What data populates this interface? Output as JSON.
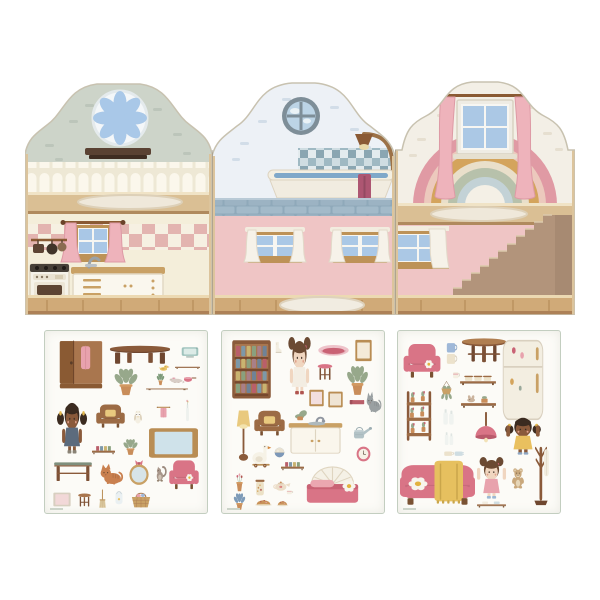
{
  "scene": {
    "kind": "dollhouse-sticker-playset-product-image",
    "background": "#ffffff"
  },
  "palette": {
    "gable_sage": "#cdd4c9",
    "gable_blue_white": "#edf1f6",
    "gable_cream": "#f3efe6",
    "wall_cream": "#f4eeda",
    "wall_pink": "#efc5c5",
    "wood_floor": "#d0aa78",
    "wood_trim": "#bd9257",
    "furniture_pink": "#d97486",
    "furniture_wood": "#9c6b45",
    "curtain_pink": "#eeb3bb",
    "blanket_yellow": "#e6c05f",
    "tile_blue": "#9fb9c3",
    "pane_blue": "#aac8e6"
  },
  "house": {
    "panels": [
      {
        "id": "kitchen-panel",
        "upper_room": "attic-lounge",
        "upper_features": [
          "rosette-flower-window",
          "wall-shelf",
          "scalloped-wainscot",
          "oval-rug"
        ],
        "lower_room": "kitchen",
        "lower_features": [
          "pink-curtain-window",
          "checkered-backsplash",
          "stove-oven",
          "counter-cabinet",
          "sink-faucet",
          "hanging-pan-rail"
        ],
        "wall_colors": {
          "upper": "#cdd4c9",
          "lower": "#f4eeda"
        }
      },
      {
        "id": "bathroom-panel",
        "upper_room": "bathroom",
        "upper_features": [
          "porthole-window",
          "tile-splashback",
          "bathtub",
          "shower-lamp-fixture",
          "hanging-towel",
          "blue-brick-ledge"
        ],
        "lower_room": "hallway",
        "lower_features": [
          "white-curtain-window-left",
          "white-curtain-window-right",
          "white-rug"
        ],
        "wall_colors": {
          "upper": "#edf1f6",
          "lower": "#efc5c5"
        }
      },
      {
        "id": "bedroom-panel",
        "upper_room": "attic-bedroom",
        "upper_features": [
          "rainbow-mural",
          "pink-curtain-window",
          "oval-rug"
        ],
        "lower_room": "stair-hall",
        "lower_features": [
          "white-curtain-window",
          "staircase"
        ],
        "wall_colors": {
          "upper": "#f3efe6",
          "lower": "#efc5c5"
        },
        "rainbow_colors": [
          "#e09aa4",
          "#ecc9bd",
          "#d4a45c",
          "#e9dfca",
          "#b7c1ab",
          "#c3d2d6"
        ]
      }
    ]
  },
  "sticker_sheets": [
    {
      "id": "sheet-living",
      "items": [
        {
          "name": "wardrobe",
          "type": "wardrobe",
          "x": 13,
          "y": 8,
          "w": 46,
          "h": 52
        },
        {
          "name": "coffee-table",
          "type": "table",
          "x": 63,
          "y": 13,
          "w": 64,
          "h": 22,
          "top": "#8a5a3a"
        },
        {
          "name": "tv",
          "type": "tv",
          "x": 136,
          "y": 14,
          "w": 18,
          "h": 14
        },
        {
          "name": "wall-shelf",
          "type": "plank",
          "x": 130,
          "y": 30,
          "w": 25,
          "h": 9,
          "items": "none"
        },
        {
          "name": "potted-plant",
          "type": "plant",
          "x": 64,
          "y": 34,
          "w": 34,
          "h": 32
        },
        {
          "name": "duck-toy",
          "type": "animal",
          "kind": "duck",
          "x": 113,
          "y": 32,
          "w": 12,
          "h": 9
        },
        {
          "name": "cactus-pot",
          "type": "plant",
          "x": 110,
          "y": 41,
          "w": 11,
          "h": 14,
          "leaf": "#7e9b7a"
        },
        {
          "name": "mouse-toy",
          "type": "animal",
          "kind": "mouse",
          "x": 123,
          "y": 44,
          "w": 17,
          "h": 9
        },
        {
          "name": "saucepan",
          "type": "pan",
          "x": 137,
          "y": 41,
          "w": 15,
          "h": 12
        },
        {
          "name": "wooden-plank",
          "type": "plank",
          "x": 101,
          "y": 53,
          "w": 42,
          "h": 7,
          "items": "none"
        },
        {
          "name": "doll-girl-pigtails",
          "type": "doll",
          "x": 11,
          "y": 68,
          "w": 32,
          "h": 55,
          "skin": "#8a5a3b",
          "hair": "#3b2b20",
          "dress": "#5c6b7d",
          "style": "pigtails",
          "boots": "#8a8376"
        },
        {
          "name": "armchair-brown",
          "type": "chair",
          "x": 50,
          "y": 70,
          "w": 31,
          "h": 29,
          "body": "#9c6b45",
          "pillow": "#e9c97e"
        },
        {
          "name": "owl",
          "type": "animal",
          "kind": "owl",
          "x": 87,
          "y": 76,
          "w": 12,
          "h": 18
        },
        {
          "name": "towel-rail",
          "type": "towel",
          "x": 111,
          "y": 73,
          "w": 15,
          "h": 17,
          "color": "#e8a2ad"
        },
        {
          "name": "flower-vase",
          "type": "bottle",
          "x": 138,
          "y": 68,
          "w": 9,
          "h": 24,
          "flower": true
        },
        {
          "name": "book-shelf-small",
          "type": "plank",
          "x": 47,
          "y": 110,
          "w": 23,
          "h": 15,
          "items": "books"
        },
        {
          "name": "potted-plant-small",
          "type": "plant",
          "x": 75,
          "y": 106,
          "w": 21,
          "h": 19
        },
        {
          "name": "framed-board",
          "type": "board",
          "x": 103,
          "y": 96,
          "w": 51,
          "h": 32
        },
        {
          "name": "desk",
          "type": "desk",
          "x": 8,
          "y": 126,
          "w": 40,
          "h": 27,
          "top": "#7f8f7d"
        },
        {
          "name": "cat-orange",
          "type": "animal",
          "kind": "cat",
          "x": 53,
          "y": 130,
          "w": 26,
          "h": 25,
          "color": "#c9804f"
        },
        {
          "name": "oval-mirror",
          "type": "ovalmirror",
          "x": 82,
          "y": 128,
          "w": 24,
          "h": 27
        },
        {
          "name": "squirrel-toy",
          "type": "animal",
          "kind": "squirrel",
          "x": 108,
          "y": 133,
          "w": 15,
          "h": 19
        },
        {
          "name": "pink-armchair",
          "type": "chair",
          "x": 123,
          "y": 125,
          "w": 32,
          "h": 36,
          "body": "#d97486",
          "daisy": true
        },
        {
          "name": "picture-frame",
          "type": "board",
          "x": 8,
          "y": 161,
          "w": 18,
          "h": 15,
          "frame": "#d8cfc0",
          "inner": "#f2d8d8"
        },
        {
          "name": "stool",
          "type": "stool",
          "x": 30,
          "y": 160,
          "w": 19,
          "h": 18
        },
        {
          "name": "dustpan-brush",
          "type": "broom",
          "x": 52,
          "y": 158,
          "w": 11,
          "h": 20
        },
        {
          "name": "bib",
          "type": "bib",
          "x": 66,
          "y": 160,
          "w": 16,
          "h": 17
        },
        {
          "name": "toy-basket",
          "type": "basket",
          "x": 84,
          "y": 158,
          "w": 24,
          "h": 20
        }
      ]
    },
    {
      "id": "sheet-bedroom",
      "items": [
        {
          "name": "bookcase",
          "type": "bookshelf",
          "x": 9,
          "y": 8,
          "w": 41,
          "h": 62
        },
        {
          "name": "boot",
          "type": "boot",
          "x": 50,
          "y": 10,
          "w": 11,
          "h": 14
        },
        {
          "name": "doll-girl-buns",
          "type": "doll",
          "x": 62,
          "y": 6,
          "w": 31,
          "h": 58,
          "skin": "#f0d6c0",
          "hair": "#6b4a33",
          "dress": "#f3ede2",
          "style": "buns",
          "boots": "#b0544f"
        },
        {
          "name": "pet-basket",
          "type": "petbed",
          "x": 95,
          "y": 10,
          "w": 33,
          "h": 18
        },
        {
          "name": "picture-frame-tall",
          "type": "board",
          "x": 133,
          "y": 8,
          "w": 17,
          "h": 23,
          "frame": "#b98d54",
          "inner": "#f4ead8"
        },
        {
          "name": "pink-stool",
          "type": "stool",
          "x": 92,
          "y": 30,
          "w": 22,
          "h": 22,
          "top": "#d97486"
        },
        {
          "name": "potted-plant",
          "type": "plant",
          "x": 120,
          "y": 31,
          "w": 31,
          "h": 35
        },
        {
          "name": "small-frame-a",
          "type": "board",
          "x": 87,
          "y": 58,
          "w": 15,
          "h": 18,
          "frame": "#b98d54",
          "inner": "#f2dede"
        },
        {
          "name": "small-frame-b",
          "type": "board",
          "x": 106,
          "y": 60,
          "w": 15,
          "h": 17,
          "frame": "#b98d54",
          "inner": "#efe4d4"
        },
        {
          "name": "red-book",
          "type": "book",
          "x": 126,
          "y": 66,
          "w": 18,
          "h": 10
        },
        {
          "name": "cat-grey",
          "type": "animal",
          "kind": "cat",
          "x": 143,
          "y": 58,
          "w": 17,
          "h": 25,
          "color": "#9aa0a2"
        },
        {
          "name": "floor-lamp",
          "type": "lamp",
          "x": 10,
          "y": 75,
          "w": 23,
          "h": 57
        },
        {
          "name": "armchair-brown",
          "type": "chair",
          "x": 31,
          "y": 76,
          "w": 33,
          "h": 31,
          "body": "#9c6b45",
          "pillow": "#e9c97e"
        },
        {
          "name": "sink-cabinet",
          "type": "sink",
          "x": 65,
          "y": 78,
          "w": 57,
          "h": 47
        },
        {
          "name": "watering-can",
          "type": "wateringcan",
          "x": 128,
          "y": 91,
          "w": 22,
          "h": 20
        },
        {
          "name": "goose-pull-toy",
          "type": "animal",
          "kind": "goose",
          "x": 27,
          "y": 111,
          "w": 24,
          "h": 26
        },
        {
          "name": "ball",
          "type": "ball",
          "x": 52,
          "y": 116,
          "w": 11,
          "h": 11
        },
        {
          "name": "wall-clock",
          "type": "clock",
          "x": 134,
          "y": 115,
          "w": 15,
          "h": 16
        },
        {
          "name": "book-shelf",
          "type": "plank",
          "x": 59,
          "y": 126,
          "w": 23,
          "h": 15,
          "items": "books"
        },
        {
          "name": "bed",
          "type": "bed",
          "x": 82,
          "y": 125,
          "w": 57,
          "h": 52
        },
        {
          "name": "flower-pot",
          "type": "flowerpot",
          "x": 10,
          "y": 140,
          "w": 15,
          "h": 22
        },
        {
          "name": "storage-jar",
          "type": "jar",
          "x": 30,
          "y": 145,
          "w": 16,
          "h": 21
        },
        {
          "name": "teapot",
          "type": "teapot",
          "x": 50,
          "y": 146,
          "w": 20,
          "h": 16
        },
        {
          "name": "teacup",
          "type": "cup",
          "x": 62,
          "y": 156,
          "w": 11,
          "h": 9
        },
        {
          "name": "potted-plant-blue",
          "type": "plant",
          "x": 9,
          "y": 160,
          "w": 17,
          "h": 20,
          "leaf": "#7e9bb8"
        },
        {
          "name": "cake-plate",
          "type": "cake",
          "x": 32,
          "y": 163,
          "w": 19,
          "h": 13
        },
        {
          "name": "muffin",
          "type": "cake",
          "x": 54,
          "y": 165,
          "w": 13,
          "h": 11
        }
      ]
    },
    {
      "id": "sheet-playroom",
      "items": [
        {
          "name": "pink-armchair",
          "type": "chair",
          "x": 4,
          "y": 8,
          "w": 40,
          "h": 42,
          "body": "#d97486",
          "daisy": true
        },
        {
          "name": "mug-stack",
          "type": "mugs",
          "x": 45,
          "y": 10,
          "w": 16,
          "h": 26
        },
        {
          "name": "round-table",
          "type": "roundtable",
          "x": 62,
          "y": 6,
          "w": 48,
          "h": 28
        },
        {
          "name": "fridge",
          "type": "fridge",
          "x": 102,
          "y": 8,
          "w": 46,
          "h": 82
        },
        {
          "name": "small-pot",
          "type": "cup",
          "x": 52,
          "y": 36,
          "w": 12,
          "h": 14
        },
        {
          "name": "jar-shelf",
          "type": "plank",
          "x": 62,
          "y": 40,
          "w": 36,
          "h": 16,
          "items": "jars"
        },
        {
          "name": "hanging-plant",
          "type": "hangplant",
          "x": 37,
          "y": 50,
          "w": 23,
          "h": 24
        },
        {
          "name": "rabbit-shelf",
          "type": "plank",
          "x": 63,
          "y": 60,
          "w": 35,
          "h": 19,
          "items": "bunny"
        },
        {
          "name": "plant-stand",
          "type": "ladder",
          "x": 5,
          "y": 58,
          "w": 32,
          "h": 55
        },
        {
          "name": "milk-bottles",
          "type": "bottles",
          "x": 42,
          "y": 72,
          "w": 17,
          "h": 24
        },
        {
          "name": "pendant-lamp",
          "type": "pendant",
          "x": 72,
          "y": 81,
          "w": 32,
          "h": 39
        },
        {
          "name": "doll-girl-arms-up-yellow",
          "type": "doll",
          "x": 106,
          "y": 84,
          "w": 38,
          "h": 40,
          "skin": "#8a5a3b",
          "hair": "#3b2b20",
          "dress": "#e9c05f",
          "style": "pigtails",
          "armsUp": true,
          "boots": "#8ea7c4"
        },
        {
          "name": "bottles-small",
          "type": "bottles",
          "x": 44,
          "y": 96,
          "w": 14,
          "h": 20
        },
        {
          "name": "cup-pair",
          "type": "mugs",
          "x": 45,
          "y": 116,
          "w": 21,
          "h": 12,
          "pair": true
        },
        {
          "name": "sofa",
          "type": "sofa",
          "x": 2,
          "y": 122,
          "w": 75,
          "h": 55
        },
        {
          "name": "doll-girl-arms-up-pink",
          "type": "doll",
          "x": 77,
          "y": 126,
          "w": 33,
          "h": 42,
          "skin": "#f0d6c0",
          "hair": "#6b4a33",
          "dress": "#e8a2ad",
          "style": "buns",
          "armsUp": true,
          "boots": "#9db8d4"
        },
        {
          "name": "teddy-bear",
          "type": "animal",
          "kind": "teddy",
          "x": 111,
          "y": 136,
          "w": 18,
          "h": 22
        },
        {
          "name": "coat-rack",
          "type": "coatrack",
          "x": 128,
          "y": 112,
          "w": 30,
          "h": 64
        },
        {
          "name": "cup-shelf",
          "type": "plank",
          "x": 79,
          "y": 165,
          "w": 29,
          "h": 13,
          "items": "cups"
        }
      ]
    }
  ]
}
